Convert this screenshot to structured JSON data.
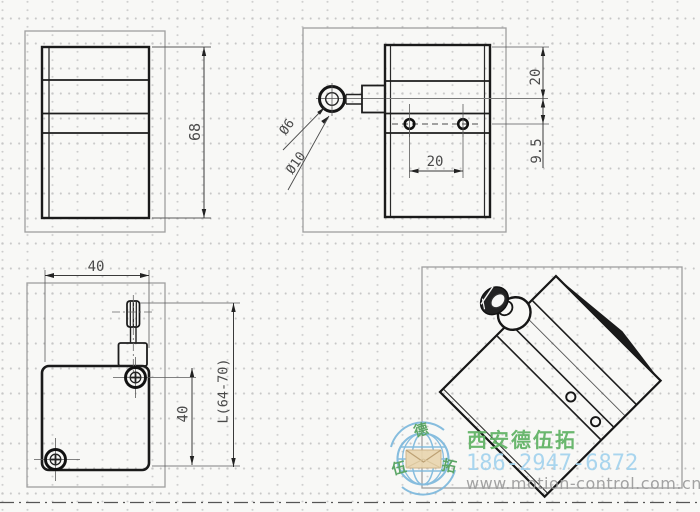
{
  "dimensions": {
    "back_view": {
      "height": "68"
    },
    "side_view": {
      "top_to_center": "20",
      "center_to_holes": "9.5",
      "hole_spacing": "20",
      "wire_diameter": "Ø6",
      "loop_diameter": "Ø10"
    },
    "front_view": {
      "width": "40",
      "hole_to_bottom": "40",
      "overall_length": "L(64-70)"
    }
  },
  "watermark": {
    "company": "西安德伍拓",
    "phone": "186-2947-6872",
    "website": "www.motion-control.com.cn",
    "logo_characters": {
      "top": "德",
      "left": "伍",
      "right": "拓"
    },
    "colors": {
      "company_green": "#5fb263",
      "phone_blue": "#a3d3ee",
      "website_gray": "#9b9b9b",
      "logo_blue": "#7db8dd",
      "envelope_tan": "#e9d6b0"
    }
  }
}
